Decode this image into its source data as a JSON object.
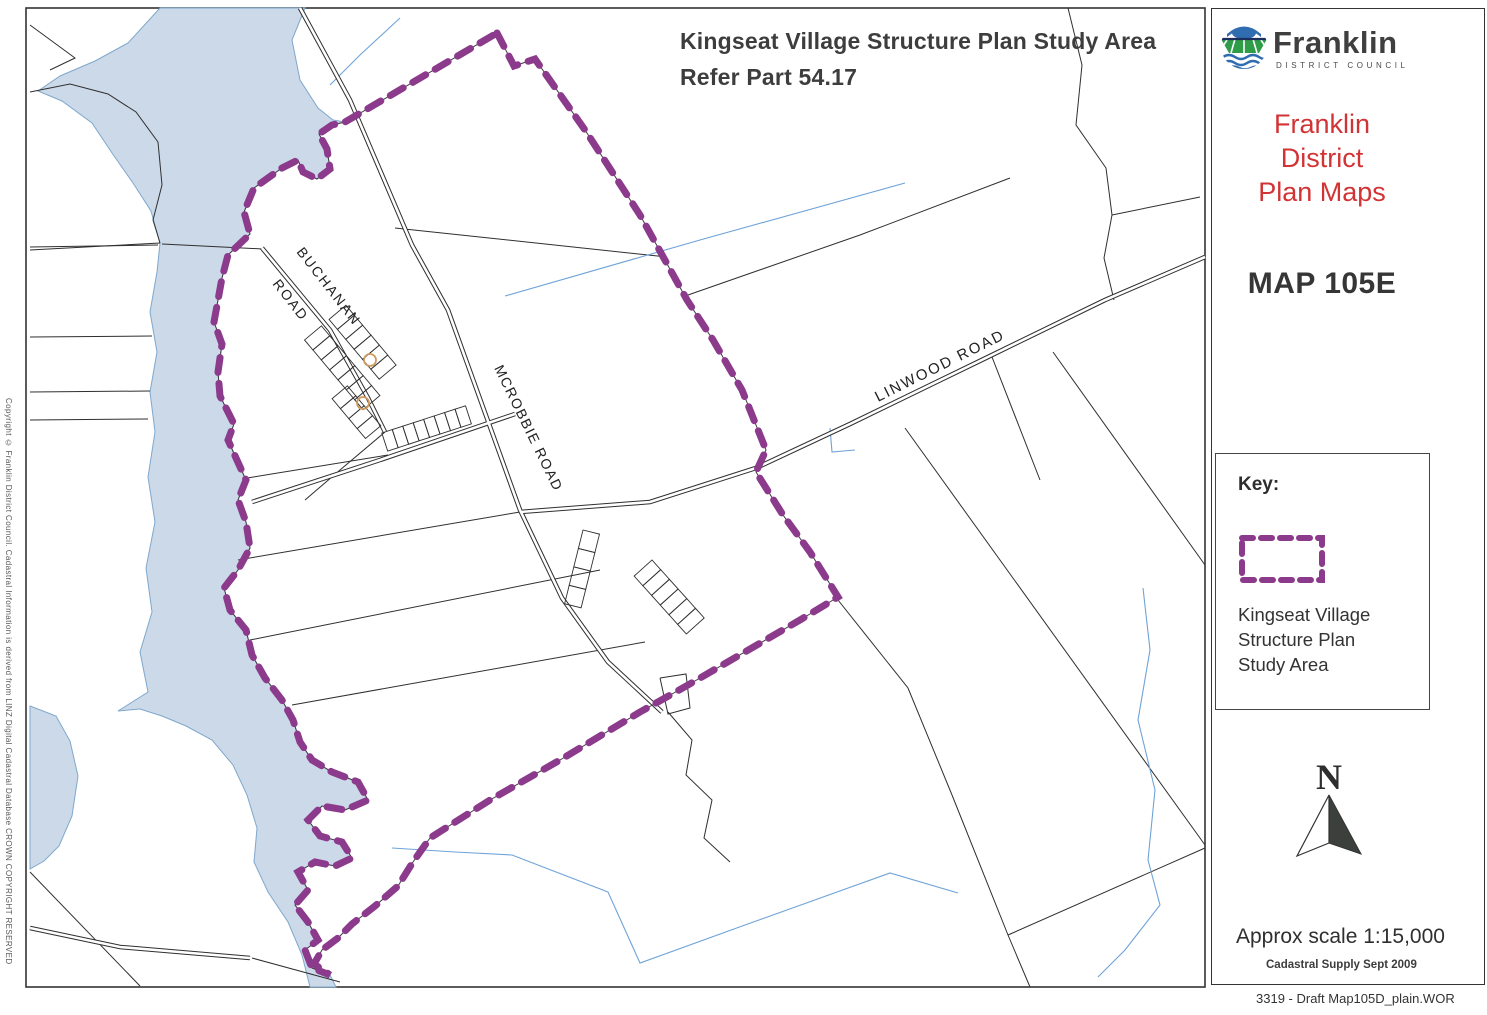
{
  "map": {
    "title_line1": "Kingseat Village Structure Plan Study Area",
    "title_line2": "Refer Part 54.17",
    "roads": {
      "buchanan_line1": "BUCHANAN",
      "buchanan_line2": "ROAD",
      "mcrobbie": "MCROBBIE ROAD",
      "linwood": "LINWOOD ROAD"
    },
    "copyright": "Copyright © Franklin District Council.  Cadastral Information is derived from LINZ Digital Cadastral Database  CROWN COPYRIGHT RESERVED"
  },
  "panel": {
    "logo": {
      "name": "Franklin",
      "subtitle": "DISTRICT COUNCIL"
    },
    "plan_title_lines": [
      "Franklin",
      "District",
      "Plan Maps"
    ],
    "map_code": "MAP 105E",
    "key": {
      "title": "Key:",
      "item_lines": [
        "Kingseat Village",
        "Structure Plan",
        "Study Area"
      ]
    },
    "north_label": "N",
    "scale_text": "Approx scale 1:15,000",
    "cadastral_text": "Cadastral Supply Sept 2009",
    "footer_text": "3319 - Draft Map105D_plain.WOR"
  },
  "colors": {
    "study_area_purple": "#8c3a8c",
    "lake_blue": "#cbd9e9",
    "stream_blue": "#6fa3d8",
    "plan_title_red": "#d23334",
    "parcel_line": "#2f2f2f"
  }
}
